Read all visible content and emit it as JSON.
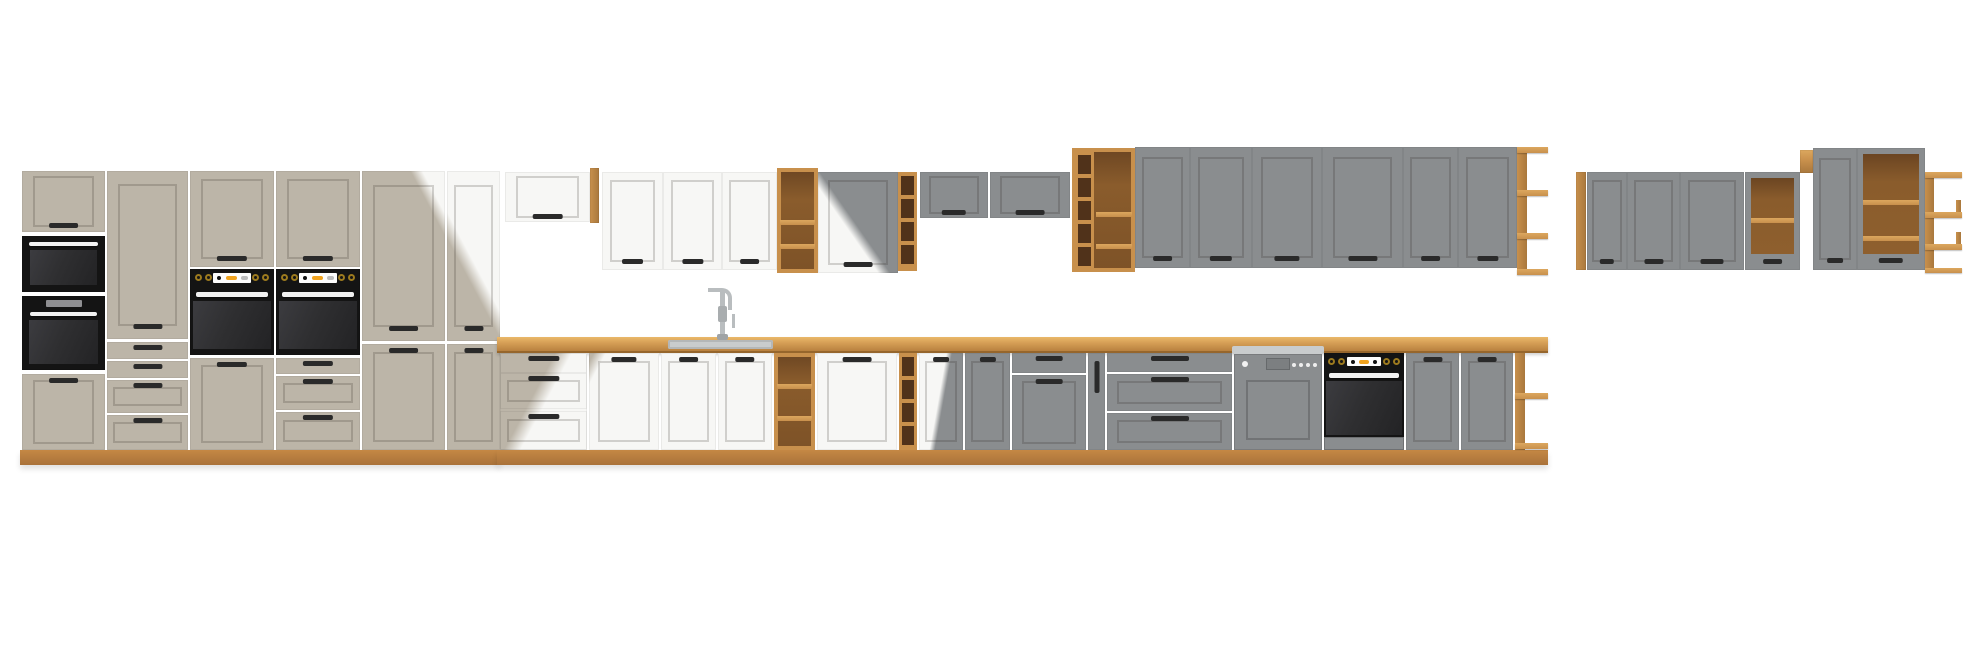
{
  "canvas": {
    "width": 1980,
    "height": 656
  },
  "scene": {
    "title": "Modular kitchen furniture set — product render on white background",
    "description": "Long composite strip of kitchen cabinet modules in three finishes (claygrey, white, dustgrey) with artisan-oak worktop, plinths and open shelf units; diagonal seams where individual module photos overlap.",
    "background": "plain white, no text or UI chrome"
  },
  "palette": {
    "background": "#ffffff",
    "clay": "#bcb5a8",
    "white_cab": "#f7f7f5",
    "grey_cab": "#8a8d8f",
    "wood": "#c8904c",
    "wood_light": "#dca75e",
    "wood_dark": "#a9783d",
    "wood_interior": "#8a5c2c",
    "wood_cubby": "#50321a",
    "appliance_black": "#141414",
    "oven_glass": "#2f2f31",
    "display_orange": "#f0a31f",
    "steel": "#c9cccd",
    "handle": "#2a2a2a",
    "frame_shadow": "rgba(35,30,22,0.18)"
  },
  "inventory": {
    "groups": [
      {
        "id": "tall-left",
        "finish": "claygrey",
        "modules": [
          "appliance housing column: top door, built-in microwave, compact oven, bottom door",
          "tall cabinet with 4 drawers below",
          "oven tower: door above, built-in oven, tall drawer-door below",
          "oven tower: door above, built-in oven, 3 drawers below",
          "double-door tall cabinet",
          "double-door tall cabinet (seam to white finish)"
        ]
      },
      {
        "id": "wall-run-middle",
        "finish": "white to dustgrey",
        "modules": [
          "lift-up wall cabinet with oak side panel",
          "3 white wall doors",
          "oak open wall shelf",
          "wall door (white/grey seam)",
          "oak wine-cubby column",
          "2 short grey lift-up wall cabinets",
          "tall oak open shelf + cubby unit",
          "6 tall grey wall doors",
          "oak open end shelf"
        ]
      },
      {
        "id": "base-run",
        "finish": "white to dustgrey",
        "modules": [
          "3-drawer base unit (clay/white seam)",
          "3 white base doors (sink run)",
          "oak open base shelf",
          "wide white base door",
          "oak wine-cubby column",
          "base door (white/grey seam)",
          "grey base door",
          "grey drawer + door unit",
          "narrow grey pull-out with vertical handle",
          "grey 3-drawer unit",
          "semi-integrated dishwasher",
          "built-in base oven with drawer",
          "2 grey base doors",
          "oak open end shelf"
        ]
      },
      {
        "id": "wall-group-right",
        "finish": "dustgrey",
        "modules": [
          "oak end strip",
          "3 grey wall doors",
          "grey open wall unit with oak interior shelf",
          "oak top filler",
          "tall grey wall door",
          "tall grey open wall unit with 2 oak shelves",
          "oak corner open shelf"
        ]
      }
    ],
    "appliances": [
      "built-in microwave",
      "compact built-in oven",
      "two built-in ovens with orange LED displays",
      "semi-integrated dishwasher",
      "built-in base oven",
      "inset sink with chrome spring faucet"
    ],
    "materials": {
      "worktop": "artisan oak",
      "plinth": "artisan oak",
      "open_shelving": "artisan oak"
    }
  }
}
